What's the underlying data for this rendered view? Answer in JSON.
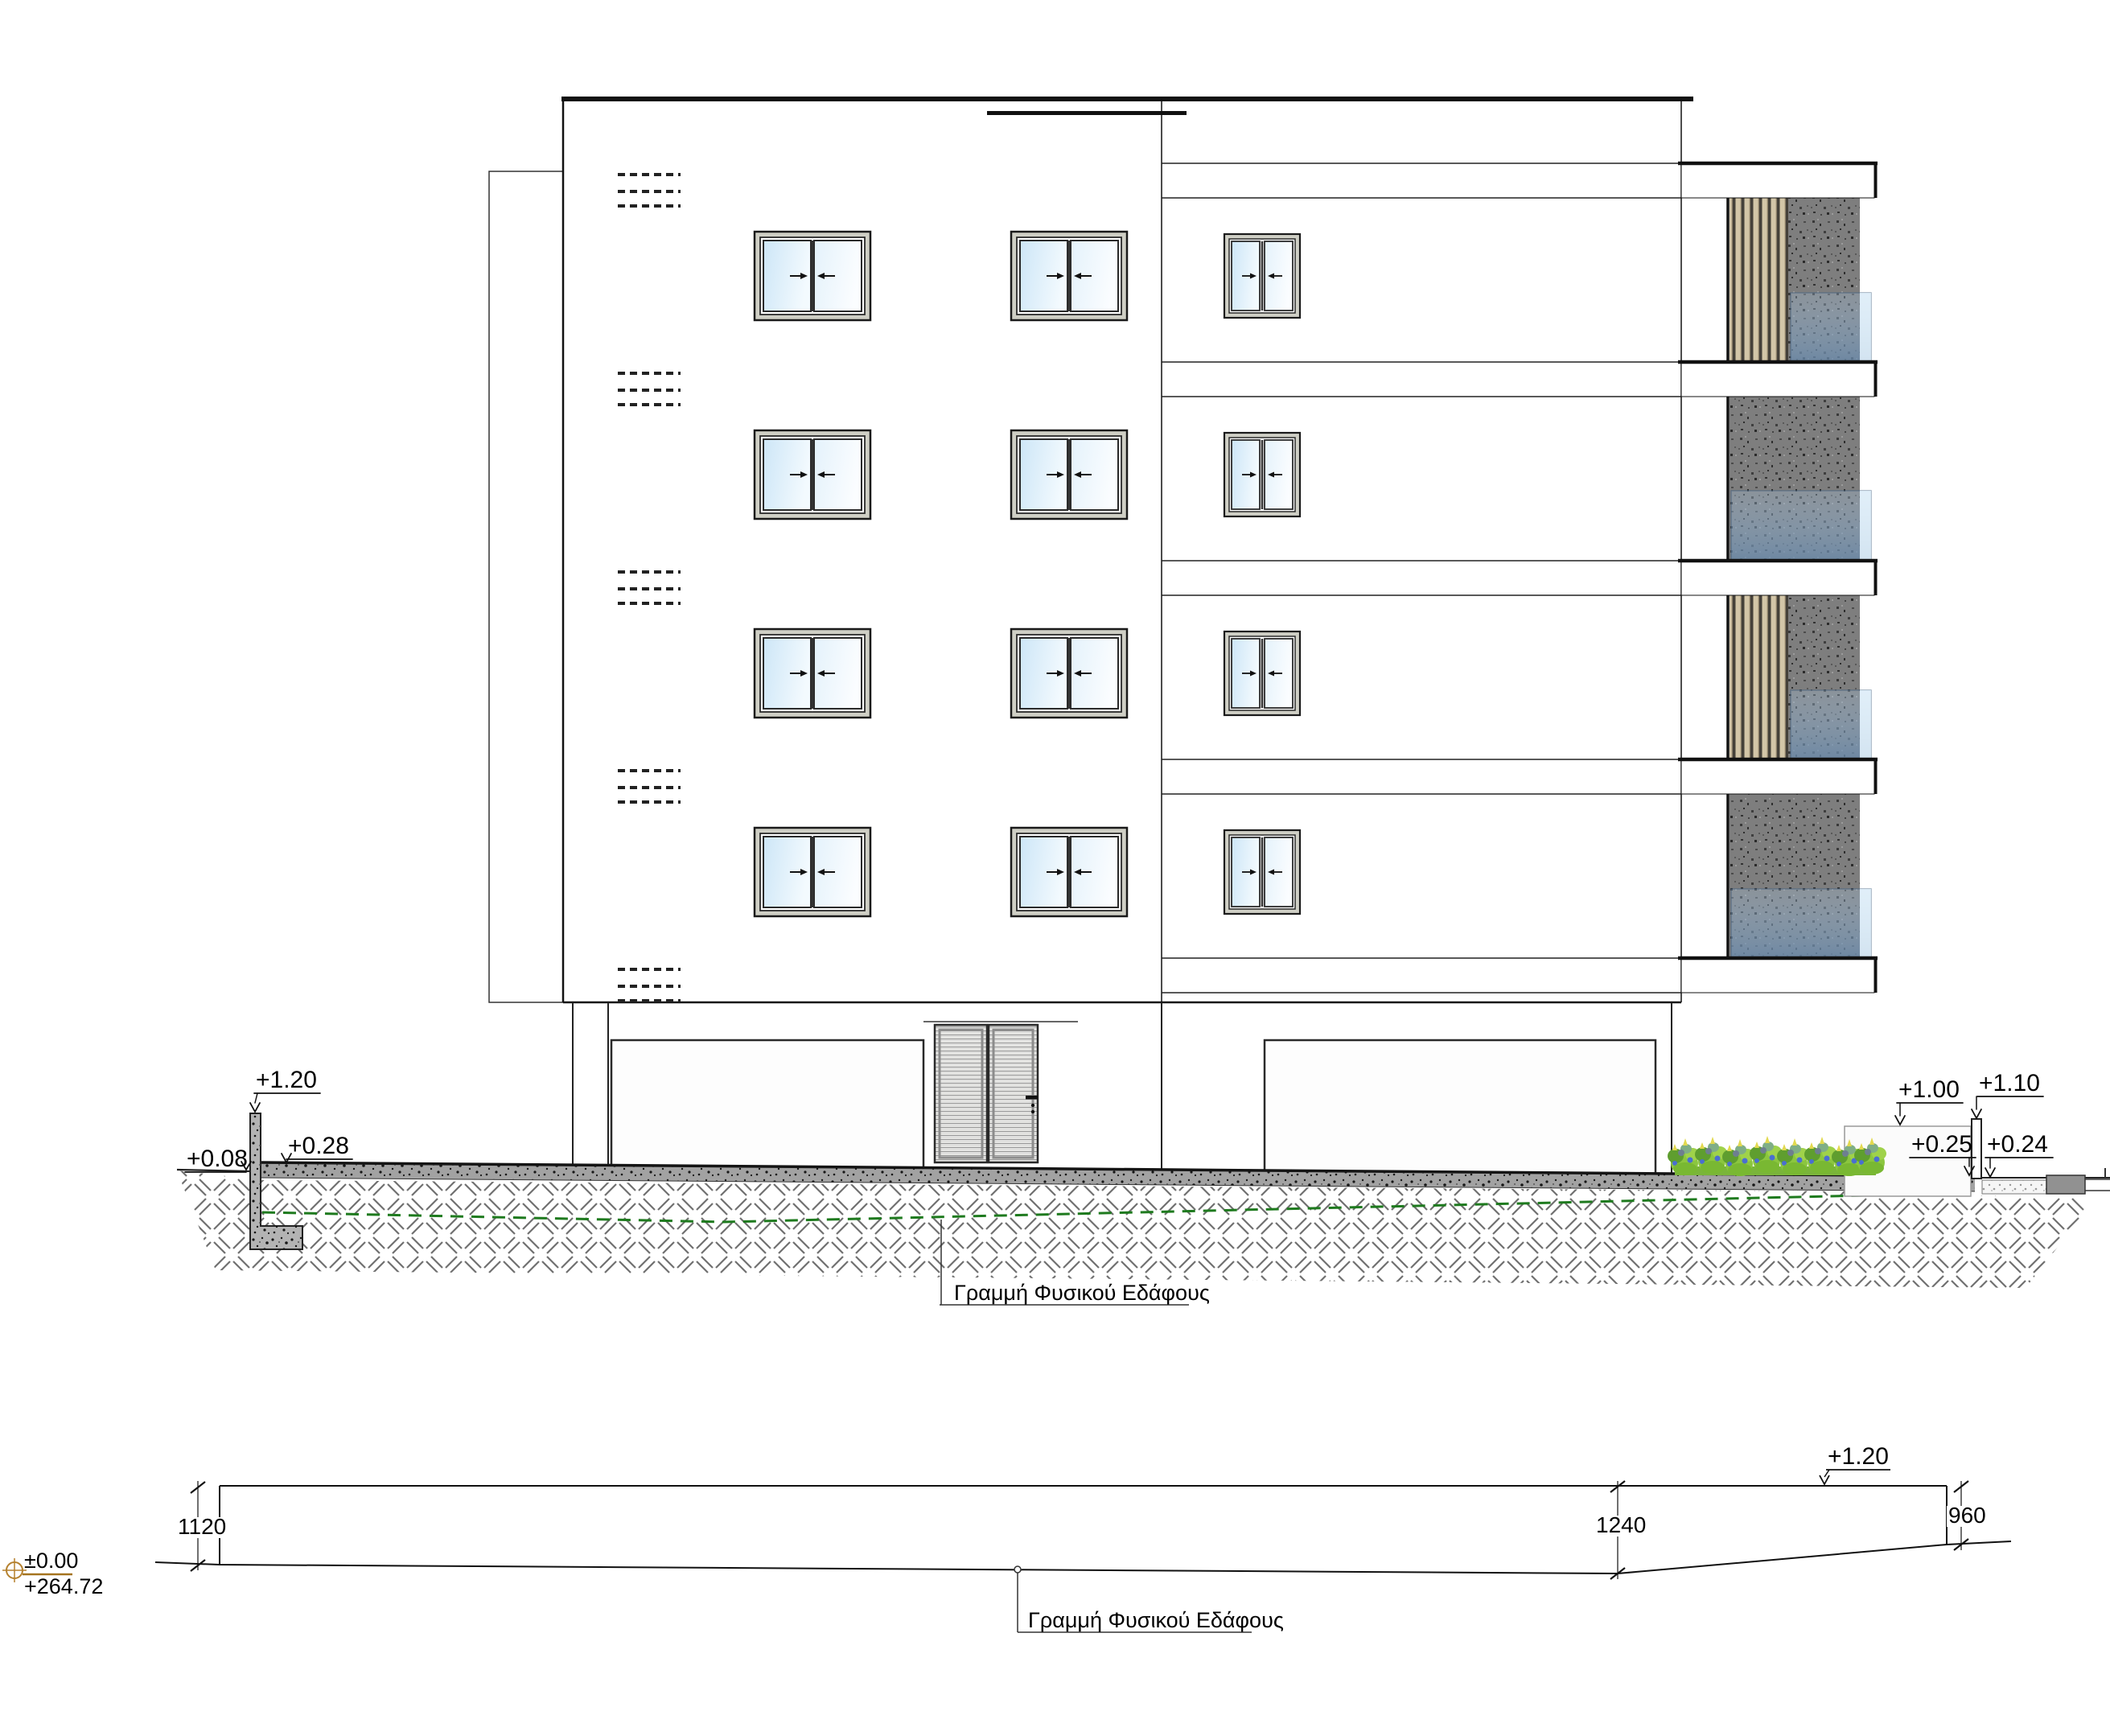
{
  "drawing": {
    "type": "building-elevation-and-ground-profile",
    "language": "el",
    "colors": {
      "line": "#111111",
      "stucco_panel": "#7e7e7e",
      "timber_slat": "#d3c6a8",
      "glass_railing": "#6f8cac",
      "window_glass": "#cde6f7",
      "pavement": "#a2a2a2",
      "plants_green": "#8bc63f",
      "flower_blue": "#4a6fd0",
      "flower_yellow": "#e2d94f",
      "datum_brown": "#b5812e",
      "natural_line_green": "#1e7a1e"
    }
  },
  "elevation": {
    "ground_label": "Γραμμή Φυσικού Εδάφους",
    "levels": {
      "retaining_wall_top": "+1.20",
      "natural_ground_left": "+0.08",
      "pavement_left": "+0.28",
      "planter_wall_top": "+1.00",
      "fence_post_top": "+1.10",
      "pavement_right": "+0.25",
      "street_right": "+0.24"
    }
  },
  "profile": {
    "ground_label": "Γραμμή Φυσικού Εδάφους",
    "datum_level": "±0.00",
    "datum_elevation": "+264.72",
    "depth_left": "1120",
    "depth_middle": "1240",
    "depth_right": "960",
    "top_level": "+1.20"
  }
}
